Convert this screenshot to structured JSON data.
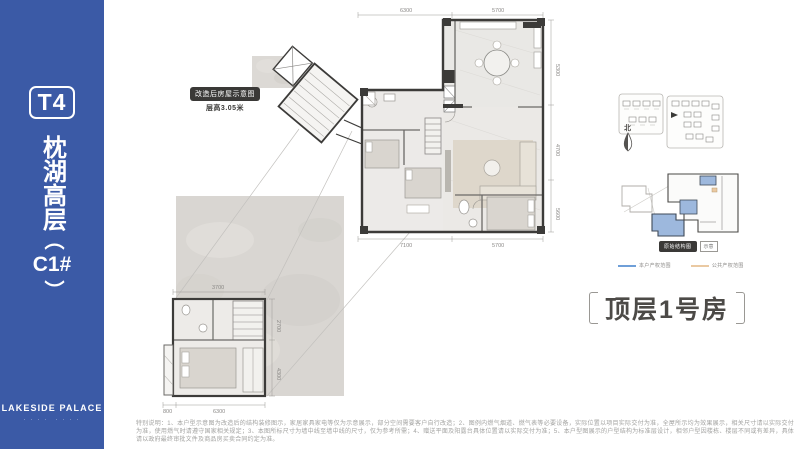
{
  "sidebar": {
    "bg_color": "#3b5aa6",
    "tower_badge": "T4",
    "title": "枕湖高层",
    "paren_open": "（",
    "unit": "C1#",
    "paren_close": "）",
    "brand": "LAKESIDE PALACE",
    "brand_sub": "· · · ·　· · · ·"
  },
  "plan_badge": {
    "line1": "改造后房屋示意图",
    "line2": "层高3.05米"
  },
  "dims": {
    "top_left": "6300",
    "top_right": "5700",
    "right_top": "5300",
    "right_mid": "4700",
    "right_bottom": "5600",
    "bottom_left": "7100",
    "bottom_right": "5700",
    "lower_top": "3700",
    "lower_right_top": "2700",
    "lower_right_bottom": "4300",
    "lower_bottom_left": "800",
    "lower_bottom_right": "6300"
  },
  "right_panel": {
    "compass_label": "北",
    "key_badge": "原始结构图",
    "key_note": "示意",
    "legend": [
      {
        "color": "#6f9fd8",
        "label": "本户产权范围"
      },
      {
        "color": "#eac9a2",
        "label": "公共产权范围"
      }
    ],
    "title": "顶层1号房",
    "title_color": "#4c4a47"
  },
  "disclaimer": "特别说明：1、本户型示意图为改造后的结构装修图示，家居家具家电等仅为示意展示，部分空间需要客户自行改造；2、图例内燃气烟道、燃气表等必要设备，实际位置以项目实际交付为准，全屋所示均为效果展示，相关尺寸请以实际交付为准，使用燃气时请遵守国家相关规定；3、本图所标尺寸为墙中线至墙中线的尺寸，仅为参考所需；4、赠送平面及阳露台具体位置请以实际交付为准；5、本户型图展示的户型结构为标准层设计，相邻户型因楼栋、楼层不同或有差异，具体请以政府最终审批文件及商品房买卖合同约定为准。"
}
